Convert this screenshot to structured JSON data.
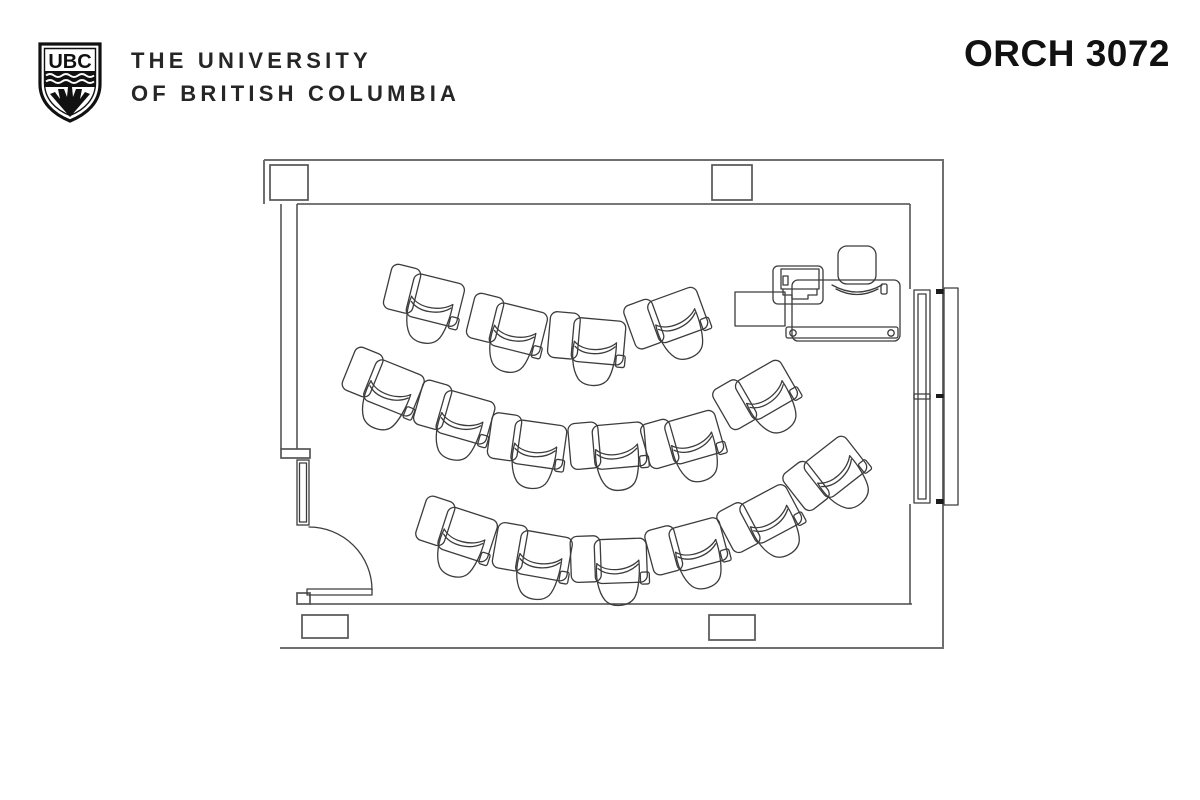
{
  "header": {
    "logo_abbr": "UBC",
    "university_line1": "THE UNIVERSITY",
    "university_line2": "OF BRITISH COLUMBIA",
    "room_code": "ORCH 3072"
  },
  "floorplan": {
    "description": "Classroom floor plan, three curved rows of tablet-arm chairs facing instructor desk at top right, door at lower left, board on right wall",
    "student_chair_count": 16,
    "colors": {
      "line": "#3c3c3c",
      "inner_wall": "#4a4a4a",
      "outer_wall": "#6f6f6f",
      "background": "#ffffff"
    },
    "rows": [
      {
        "name": "row-1",
        "chairs": [
          {
            "x": 430,
            "y": 305,
            "r": 14
          },
          {
            "x": 513,
            "y": 334,
            "r": 14
          },
          {
            "x": 594,
            "y": 347,
            "r": 5
          },
          {
            "x": 676,
            "y": 322,
            "r": -20
          }
        ]
      },
      {
        "name": "row-2",
        "chairs": [
          {
            "x": 388,
            "y": 392,
            "r": 22
          },
          {
            "x": 460,
            "y": 422,
            "r": 16
          },
          {
            "x": 534,
            "y": 450,
            "r": 8
          },
          {
            "x": 616,
            "y": 452,
            "r": -5
          },
          {
            "x": 692,
            "y": 444,
            "r": -16
          },
          {
            "x": 766,
            "y": 397,
            "r": -30
          }
        ]
      },
      {
        "name": "row-3",
        "chairs": [
          {
            "x": 462,
            "y": 539,
            "r": 18
          },
          {
            "x": 539,
            "y": 561,
            "r": 10
          },
          {
            "x": 617,
            "y": 567,
            "r": -2
          },
          {
            "x": 696,
            "y": 551,
            "r": -15
          },
          {
            "x": 770,
            "y": 521,
            "r": -28
          },
          {
            "x": 836,
            "y": 474,
            "r": -38
          }
        ]
      }
    ]
  }
}
